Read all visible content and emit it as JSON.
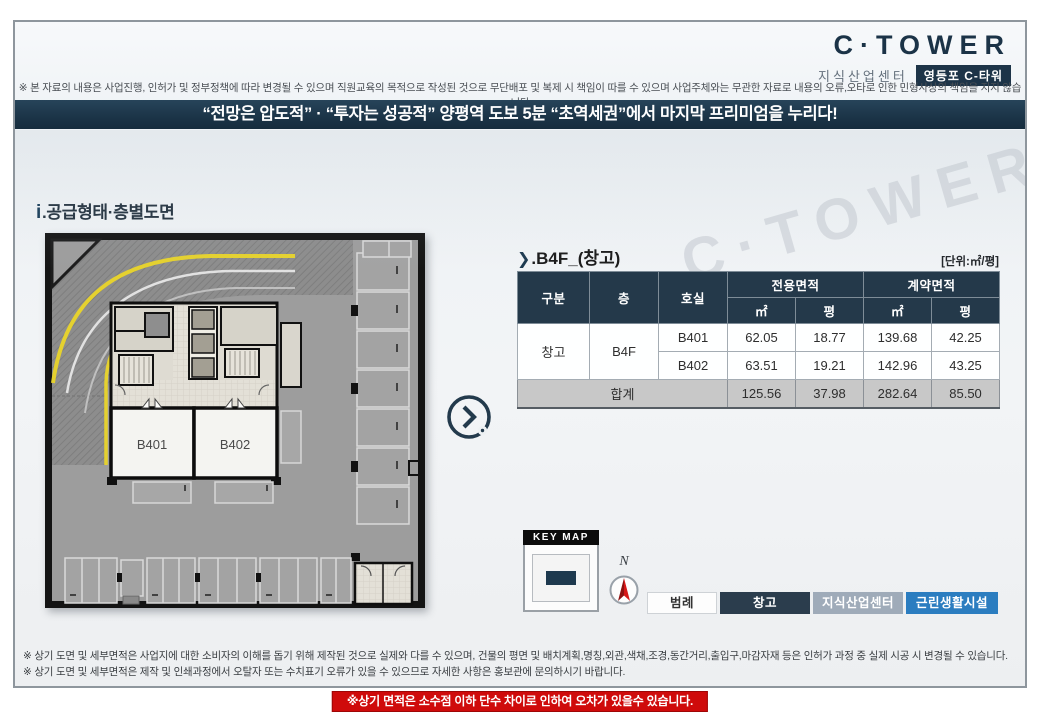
{
  "header": {
    "logo": {
      "brand": "C·TOWER",
      "subtitle": "지식산업센터",
      "badge": "영등포 C-타워"
    },
    "disclaimer": "※ 본 자료의 내용은 사업진행, 인허가 및 정부정책에 따라 변경될 수 있으며 직원교육의 목적으로 작성된 것으로 무단배포 및 복제 시 책임이 따를 수 있으며  사업주체와는 무관한 자료로 내용의 오류,오타로 인한 민형사상의 책임을 지지 않습니다",
    "banner": "“전망은 압도적” · “투자는 성공적” 양평역 도보 5분 “초역세권”에서 마지막 프리미엄을 누리다!"
  },
  "watermark": "C·TOWER",
  "section": {
    "icon": "i",
    "title": ".공급형태·층별도면"
  },
  "floorplan": {
    "unit1": "B401",
    "unit2": "B402"
  },
  "table": {
    "caption_icon": "❯",
    "caption": ".B4F_(창고)",
    "unit_note": "[단위:㎡/평]",
    "headers": {
      "category": "구분",
      "floor": "층",
      "room": "호실",
      "exclusive_group": "전용면적",
      "contract_group": "계약면적",
      "sub_m2": "㎡",
      "sub_py": "평"
    },
    "rows": [
      {
        "category": "창고",
        "floor": "B4F",
        "room": "B401",
        "exclusive_m2": "62.05",
        "exclusive_py": "18.77",
        "contract_m2": "139.68",
        "contract_py": "42.25"
      },
      {
        "room": "B402",
        "exclusive_m2": "63.51",
        "exclusive_py": "19.21",
        "contract_m2": "142.96",
        "contract_py": "43.25"
      }
    ],
    "total": {
      "label": "합계",
      "exclusive_m2": "125.56",
      "exclusive_py": "37.98",
      "contract_m2": "282.64",
      "contract_py": "85.50"
    }
  },
  "keymap": {
    "title": "KEY MAP"
  },
  "compass": {
    "north": "N"
  },
  "legend": {
    "label": "범례",
    "items": [
      {
        "label": "창고",
        "color": "#2b3d4d"
      },
      {
        "label": "지식산업센터",
        "color": "#9fabb9"
      },
      {
        "label": "근린생활시설",
        "color": "#2b7dc0"
      }
    ]
  },
  "footer": {
    "note1": "※ 상기 도면 및 세부면적은 사업지에 대한 소비자의 이해를 돕기 위해 제작된 것으로 실제와 다를 수 있으며, 건물의 평면 및 배치계획,명칭,외관,색채,조경,동간거리,출입구,마감자재 등은 인허가 과정 중 실제 시공 시 변경될 수 있습니다.",
    "note2": "※ 상기 도면 및 세부면적은  제작 및 인쇄과정에서 오탈자 또는 수치표기 오류가 있을 수 있으므로 자세한 사항은 홍보관에 문의하시기 바랍니다.",
    "warning": "※상기 면적은 소수점 이하 단수 차이로 인하여 오차가 있을수 있습니다."
  }
}
